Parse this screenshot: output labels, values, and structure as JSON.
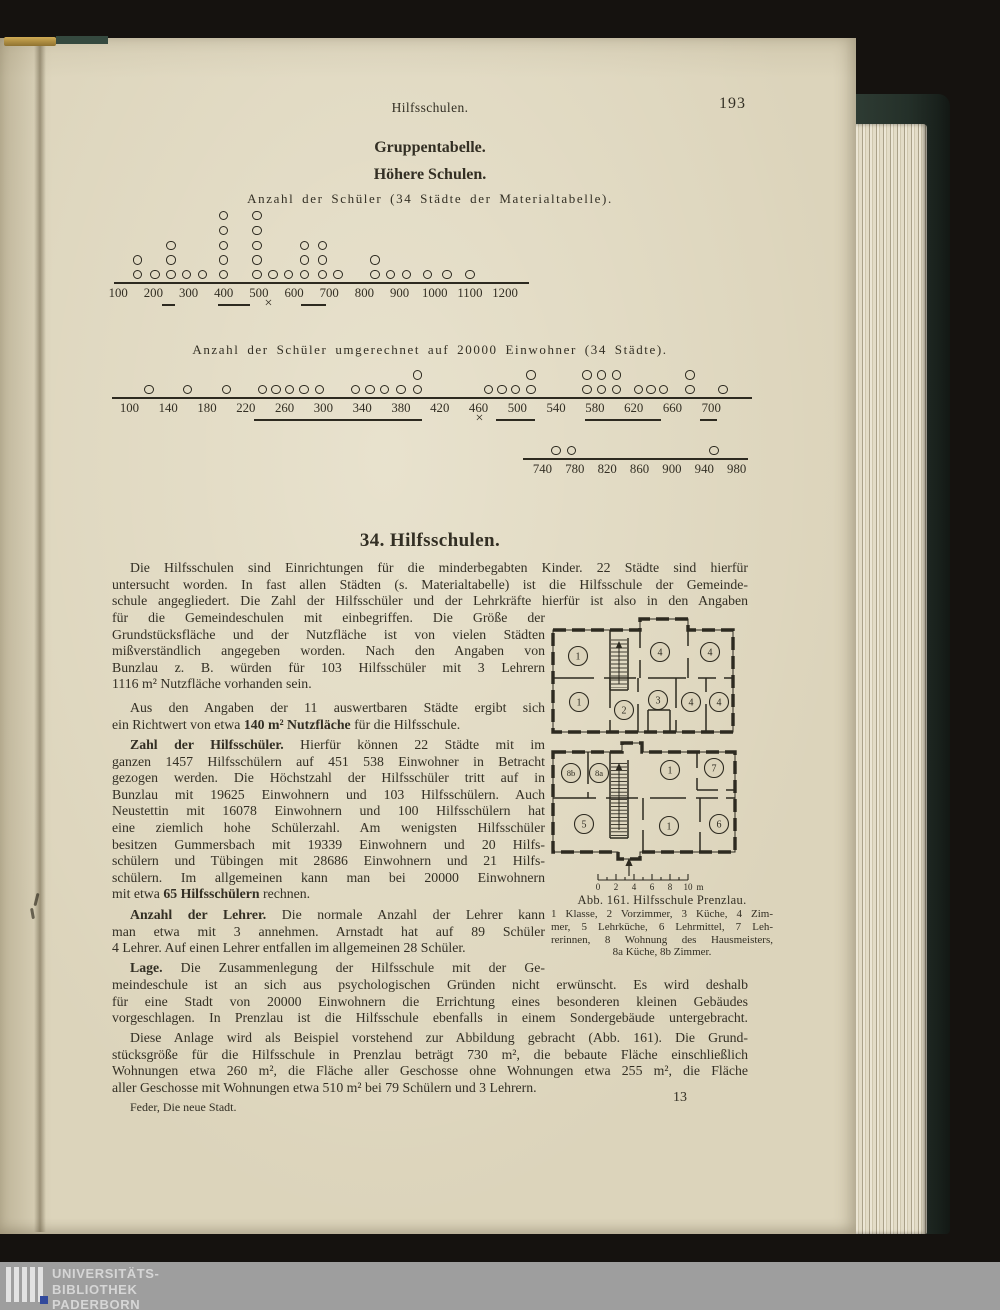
{
  "page": {
    "running_head": "Hilfsschulen.",
    "page_number": "193",
    "group_title": "Gruppentabelle.",
    "group_subtitle": "Höhere Schulen.",
    "section_heading": "34. Hilfsschulen.",
    "footer_signature": "Feder, Die neue Stadt.",
    "footer_sheet_number": "13"
  },
  "colors": {
    "page_paper": "#dcd4bb",
    "ink": "#2d2a20",
    "cover_green": "#2e3b33",
    "band_gray": "#9e9e9e",
    "logo_blue": "#31499c"
  },
  "chart_data": [
    {
      "type": "dot_plot",
      "title": "Anzahl der Schüler (34 Städte der Materialtabelle).",
      "axis": {
        "min": 88,
        "max": 1268,
        "ticks": [
          100,
          200,
          300,
          400,
          500,
          600,
          700,
          800,
          900,
          1000,
          1100,
          1200
        ]
      },
      "points": [
        [
          155,
          2
        ],
        [
          205,
          1
        ],
        [
          250,
          3
        ],
        [
          295,
          1
        ],
        [
          340,
          1
        ],
        [
          400,
          5
        ],
        [
          495,
          5
        ],
        [
          540,
          1
        ],
        [
          585,
          1
        ],
        [
          630,
          3
        ],
        [
          680,
          3
        ],
        [
          725,
          1
        ],
        [
          830,
          2
        ],
        [
          875,
          1
        ],
        [
          920,
          1
        ],
        [
          980,
          1
        ],
        [
          1035,
          1
        ],
        [
          1100,
          1
        ]
      ],
      "total_cities": 34,
      "mean": 530,
      "mean_symbol": "×",
      "range_marks": [
        [
          225,
          262
        ],
        [
          385,
          475
        ],
        [
          620,
          690
        ]
      ]
    },
    {
      "type": "dot_plot",
      "title": "Anzahl der Schüler umgerechnet auf 20000 Einwohner (34 Städte).",
      "total_cities": 34,
      "segments": [
        {
          "axis": {
            "min": 82,
            "max": 742,
            "ticks": [
              100,
              140,
              180,
              220,
              260,
              300,
              340,
              380,
              420,
              460,
              500,
              540,
              580,
              620,
              660,
              700
            ]
          },
          "points": [
            [
              120,
              1
            ],
            [
              160,
              1
            ],
            [
              200,
              1
            ],
            [
              237,
              1
            ],
            [
              251,
              1
            ],
            [
              265,
              1
            ],
            [
              280,
              1
            ],
            [
              296,
              1
            ],
            [
              333,
              1
            ],
            [
              348,
              1
            ],
            [
              363,
              1
            ],
            [
              380,
              1
            ],
            [
              397,
              2
            ],
            [
              470,
              1
            ],
            [
              484,
              1
            ],
            [
              498,
              1
            ],
            [
              514,
              2
            ],
            [
              572,
              2
            ],
            [
              587,
              2
            ],
            [
              602,
              2
            ],
            [
              625,
              1
            ],
            [
              638,
              1
            ],
            [
              651,
              1
            ],
            [
              678,
              2
            ],
            [
              712,
              1
            ]
          ],
          "mean": 462,
          "mean_symbol": "×",
          "range_marks": [
            [
              228,
              402
            ],
            [
              478,
              518
            ],
            [
              570,
              648
            ],
            [
              688,
              706
            ]
          ]
        },
        {
          "axis": {
            "min": 716,
            "max": 994,
            "ticks": [
              740,
              780,
              820,
              860,
              900,
              940,
              980
            ]
          },
          "points": [
            [
              757,
              1
            ],
            [
              776,
              1
            ],
            [
              952,
              1
            ]
          ]
        }
      ]
    }
  ],
  "article": {
    "para1_full": {
      "indent_first": true,
      "continues": true,
      "lines": [
        "Die Hilfsschulen sind Einrichtungen für die minderbegabten Kinder. 22 Städte sind hierfür",
        "untersucht worden. In fast allen Städten (s. Materialtabelle) ist die Hilfsschule der Gemeinde-",
        "schule angegliedert. Die Zahl der Hilfsschüler und der Lehrkräfte hierfür ist also in den Angaben"
      ]
    },
    "para1_narrow": {
      "indent_first": false,
      "continues": false,
      "lines": [
        "für die Gemeindeschulen mit einbegriffen. Die Größe der",
        "Grundstücksfläche und der Nutzfläche ist von vielen Städten",
        "mißverständlich angegeben worden. Nach den Angaben von",
        "Bunzlau z. B. würden für 103 Hilfsschüler mit 3 Lehrern",
        "1116 m² Nutzfläche vorhanden sein."
      ]
    },
    "para2": {
      "indent_first": true,
      "continues": false,
      "lines": [
        "Aus den Angaben der 11 auswertbaren Städte ergibt sich",
        "ein Richtwert von etwa **140 m² Nutzfläche** für die Hilfsschule."
      ]
    },
    "para3": {
      "indent_first": true,
      "continues": false,
      "lines": [
        "**Zahl der Hilfsschüler.** Hierfür können 22 Städte mit im",
        "ganzen 1457 Hilfsschülern auf 451 538 Einwohner in Betracht",
        "gezogen werden. Die Höchstzahl der Hilfsschüler tritt auf in",
        "Bunzlau mit 19625 Einwohnern und 103 Hilfsschülern. Auch",
        "Neustettin mit 16078 Einwohnern und 100 Hilfsschülern hat",
        "eine ziemlich hohe Schülerzahl. Am wenigsten Hilfsschüler",
        "besitzen Gummersbach mit 19339 Einwohnern und 20 Hilfs-",
        "schülern und Tübingen mit 28686 Einwohnern und 21 Hilfs-",
        "schülern. Im allgemeinen kann man bei 20000 Einwohnern",
        "mit etwa **65 Hilfsschülern** rechnen."
      ]
    },
    "para4": {
      "indent_first": true,
      "continues": false,
      "lines": [
        "**Anzahl der Lehrer.** Die normale Anzahl der Lehrer kann",
        "man etwa mit 3 annehmen. Arnstadt hat auf 89 Schüler",
        "4 Lehrer. Auf einen Lehrer entfallen im allgemeinen 28 Schüler."
      ]
    },
    "para5_narrow": {
      "indent_first": true,
      "continues": true,
      "lines": [
        "**Lage.** Die Zusammenlegung der Hilfsschule mit der Ge-"
      ]
    },
    "para5_full": {
      "indent_first": false,
      "continues": true,
      "lines": [
        "meindeschule ist an sich aus psychologischen Gründen nicht erwünscht. Es wird deshalb",
        "für eine Stadt von 20000 Einwohnern die Errichtung eines besonderen kleinen Gebäudes",
        "vorgeschlagen. In Prenzlau ist die Hilfsschule ebenfalls in einem Sondergebäude untergebracht."
      ]
    },
    "para6": {
      "indent_first": true,
      "continues": false,
      "lines": [
        "Diese Anlage wird als Beispiel vorstehend zur Abbildung gebracht (Abb. 161). Die Grund-",
        "stücksgröße für die Hilfsschule in Prenzlau beträgt 730 m², die bebaute Fläche einschließlich",
        "Wohnungen etwa 260 m², die Fläche aller Geschosse ohne Wohnungen etwa 255 m², die Fläche",
        "aller Geschosse mit Wohnungen etwa 510 m² bei 79 Schülern und 3 Lehrern."
      ]
    }
  },
  "figure": {
    "caption_title": "Abb. 161. Hilfsschule Prenzlau.",
    "caption": {
      "indent_first": false,
      "continues": false,
      "last_align": "center",
      "lines": [
        "1 Klasse, 2 Vorzimmer, 3 Küche, 4 Zim-",
        "mer, 5 Lehrküche, 6 Lehrmittel, 7 Leh-",
        "rerinnen, 8 Wohnung des Hausmeisters,",
        "8a Küche, 8b Zimmer."
      ]
    },
    "plan_upper_rooms": [
      "1",
      "4",
      "4",
      "1",
      "2",
      "3",
      "4",
      "4"
    ],
    "plan_lower_rooms": [
      "8b",
      "8a",
      "1",
      "7",
      "5",
      "1",
      "6"
    ],
    "scale_ticks": [
      "0",
      "2",
      "4",
      "6",
      "8",
      "10"
    ],
    "scale_unit": "m"
  },
  "library_band": {
    "lines": [
      "UNIVERSITÄTS-",
      "BIBLIOTHEK",
      "PADERBORN"
    ]
  }
}
